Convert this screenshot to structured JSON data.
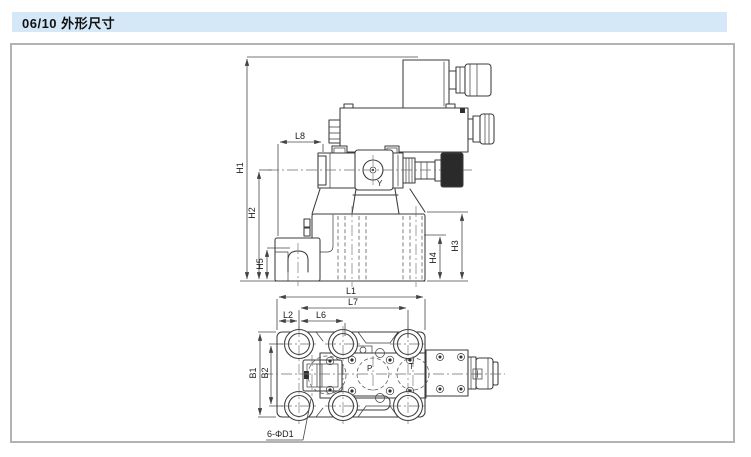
{
  "header": {
    "title": "06/10 外形尺寸"
  },
  "colors": {
    "header_bg": "#d5e8f8",
    "panel_border": "#b3b3b3",
    "line": "#3b3b3b",
    "dim_line": "#4a4a4a",
    "knob_fill": "#2a2a2a",
    "label_ink": "#1c1c1c"
  },
  "side_view": {
    "dims": {
      "h1": "H1",
      "h2": "H2",
      "h5": "H5",
      "l8": "L8",
      "h3": "H3",
      "h4": "H4"
    },
    "port_label": "Y"
  },
  "top_view": {
    "dims": {
      "l1": "L1",
      "l7": "L7",
      "l2": "L2",
      "l6": "L6",
      "b1": "B1",
      "b2": "B2"
    },
    "port_p": "P",
    "port_t": "T",
    "holes_note": "6-ΦD1"
  }
}
